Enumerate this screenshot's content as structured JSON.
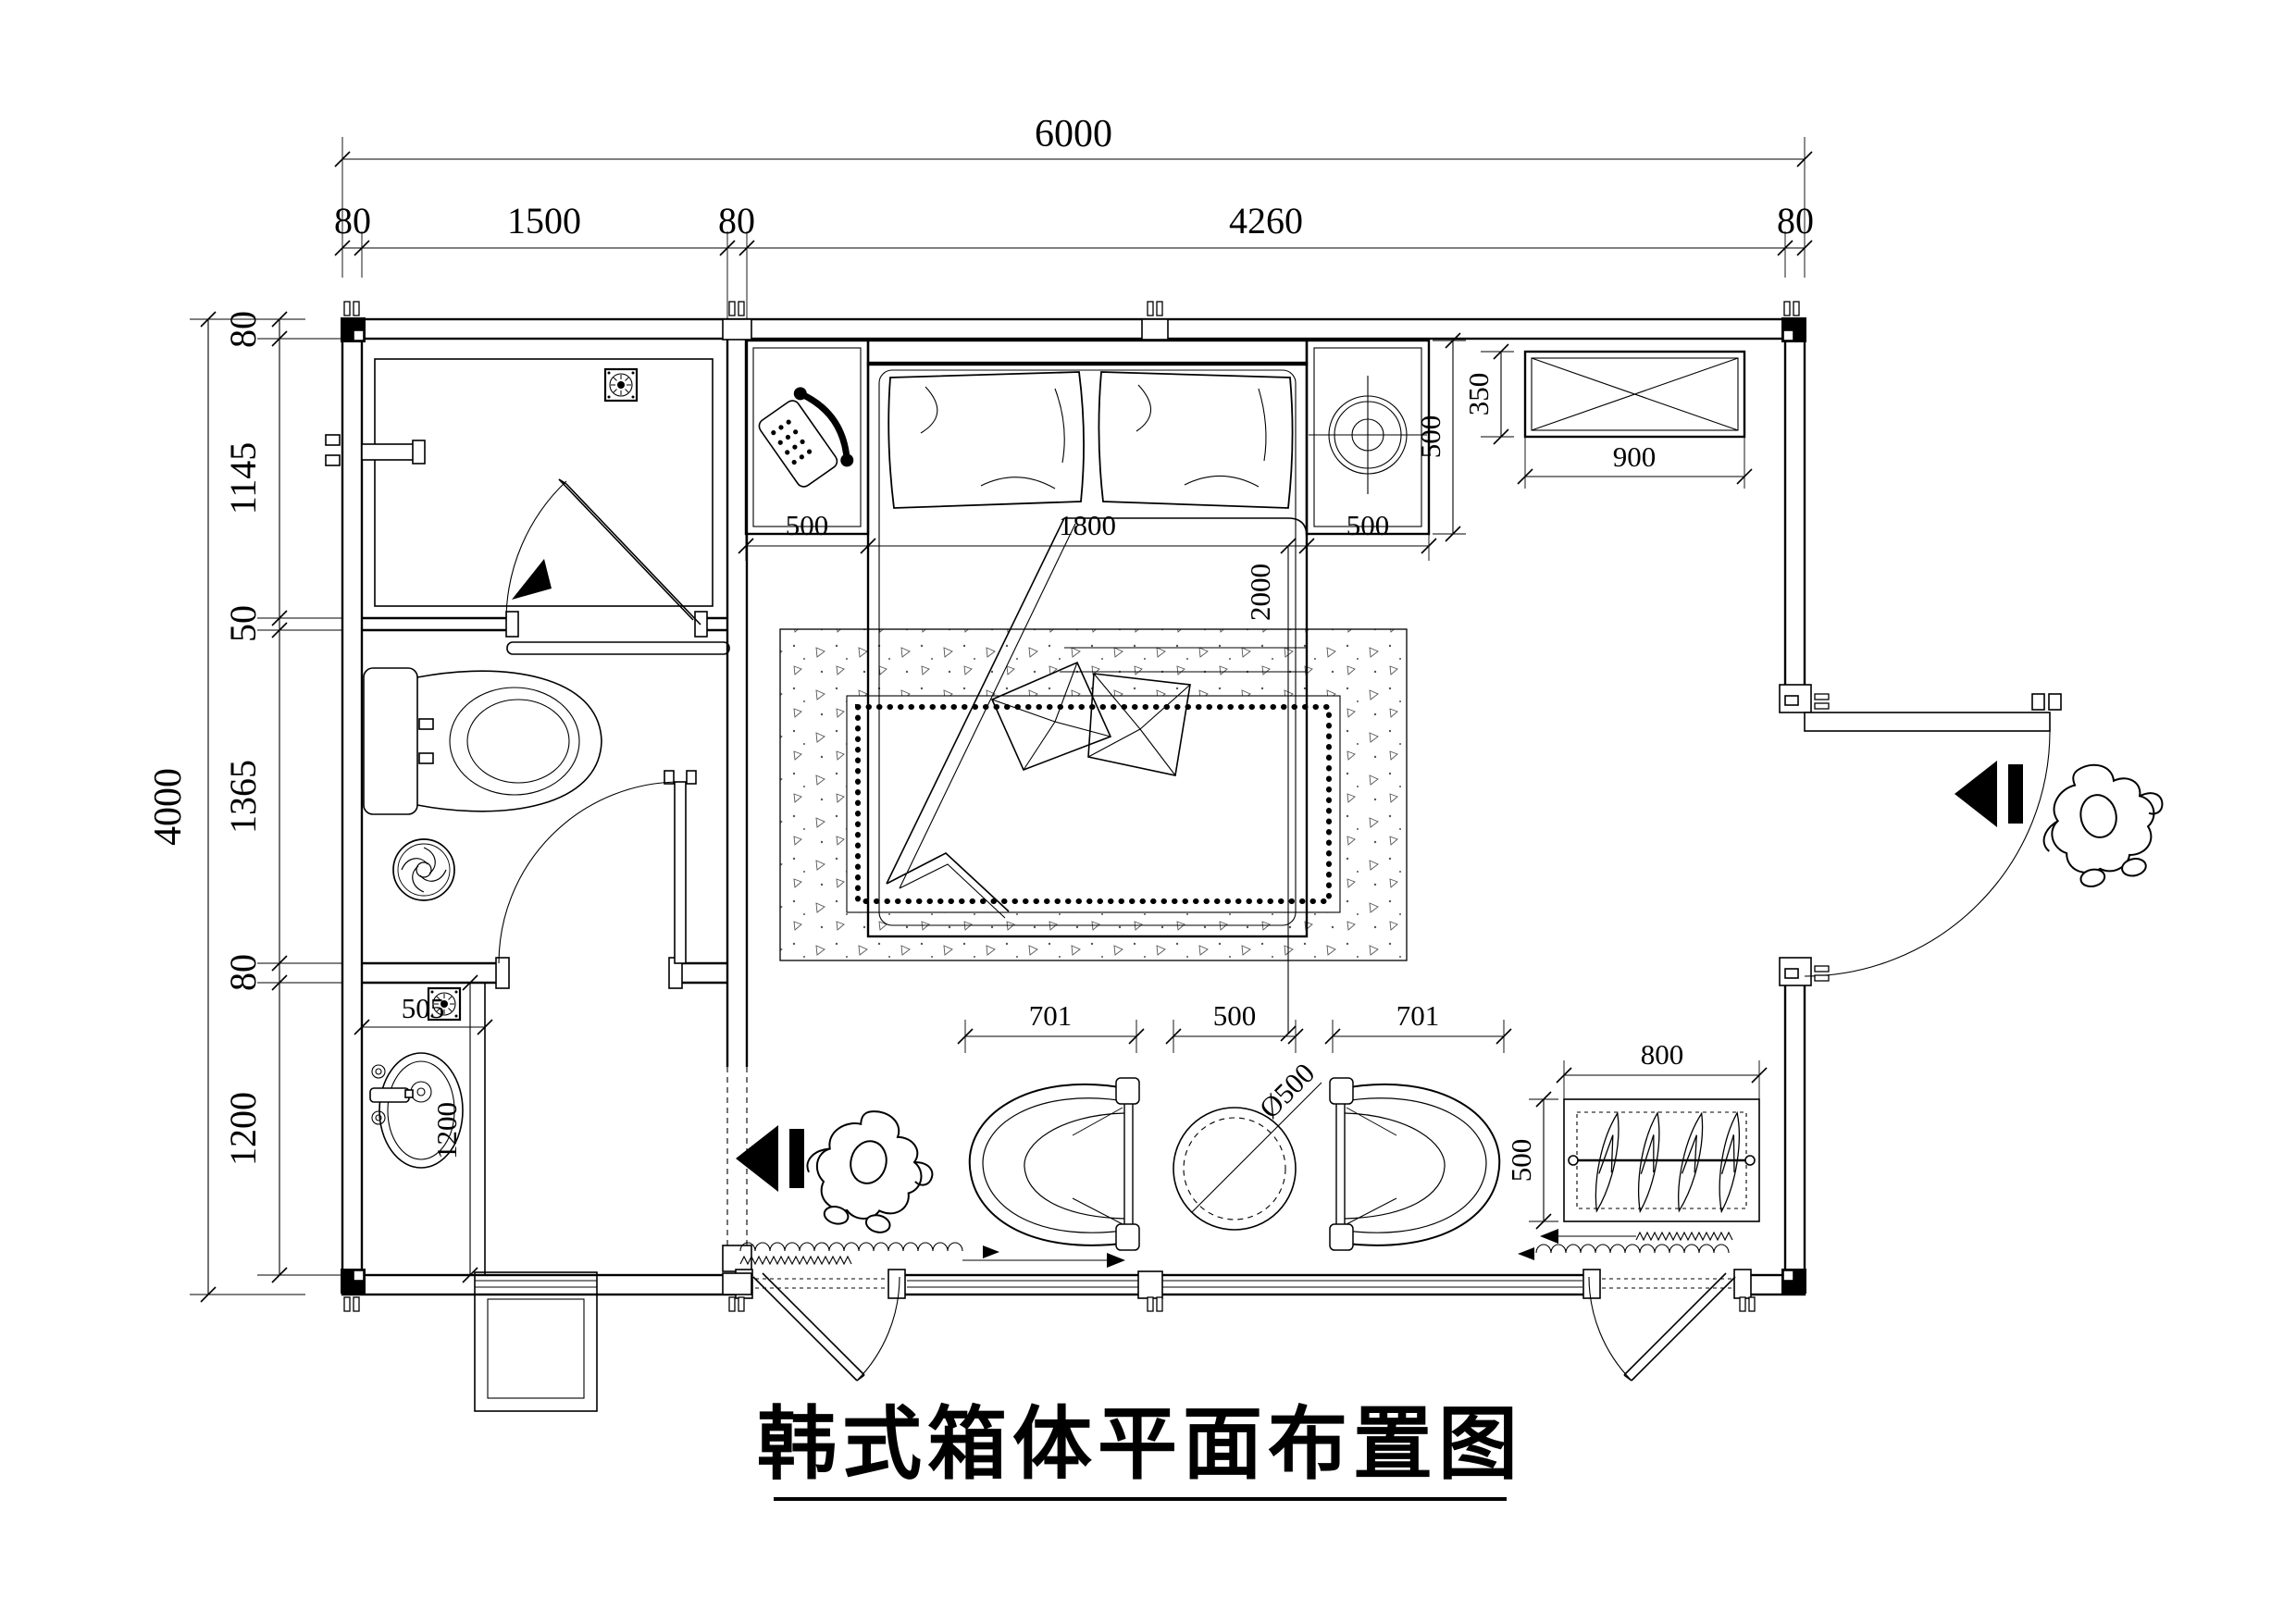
{
  "title": {
    "text": "韩式箱体平面布置图"
  },
  "dimensions": {
    "top": {
      "overall": "6000",
      "segments": [
        "80",
        "1500",
        "80",
        "4260",
        "80"
      ]
    },
    "left": {
      "overall": "4000",
      "segments": [
        "80",
        "1145",
        "50",
        "1365",
        "80",
        "1200"
      ]
    },
    "bed_area": {
      "left_offset": "500",
      "bed_width": "1800",
      "right_offset": "500",
      "bed_length": "2000"
    },
    "right_nightstand": {
      "depth": "500"
    },
    "ac_cabinet": {
      "depth": "350",
      "width": "900"
    },
    "vanity": {
      "counter_width": "505",
      "room_depth": "1200"
    },
    "seating": {
      "left_chair": "701",
      "table_zone": "500",
      "right_chair": "701",
      "table_diameter": "Ø500"
    },
    "wardrobe": {
      "width": "800",
      "depth": "500"
    }
  },
  "icons": [
    "floor-drain-icon",
    "spiral-drain-icon",
    "vent-drain-icon",
    "telephone-icon",
    "ceiling-lamp-icon",
    "toilet-icon",
    "sink-icon",
    "faucet-icon",
    "shower-door-icon",
    "door-swing-icon",
    "curtain-track-icon",
    "clothes-hanger-icon",
    "person-figure-icon",
    "direction-arrow-icon",
    "window-icon",
    "ac-cabinet-icon",
    "rug-icon"
  ]
}
